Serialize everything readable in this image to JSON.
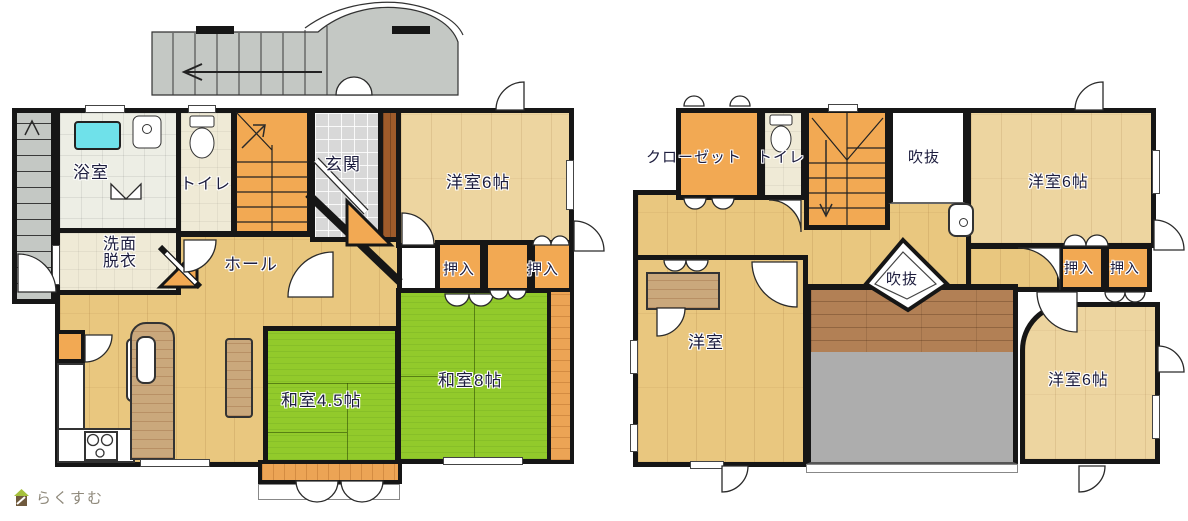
{
  "floor1": {
    "bathroom": "浴室",
    "washroom_line1": "洗面",
    "washroom_line2": "脱衣",
    "toilet": "トイレ",
    "entrance": "玄関",
    "western6": "洋室6帖",
    "hall": "ホール",
    "closet_a": "押入",
    "closet_b": "押入",
    "japanese45": "和室4.5帖",
    "japanese8": "和室8帖"
  },
  "floor2": {
    "closet": "クローゼット",
    "toilet": "トイレ",
    "void_top": "吹抜",
    "western6_ne": "洋室6帖",
    "closet_a": "押入",
    "closet_b": "押入",
    "western": "洋室",
    "void_center": "吹抜",
    "western6_se": "洋室6帖"
  },
  "watermark": {
    "icon": "house-icon",
    "text": "らくすむ"
  },
  "colors": {
    "wall": "#161616",
    "tatami_green": "#92ca2b",
    "wood_floor": "#e9c77f",
    "wood_light": "#edd5a0",
    "closet_orange": "#f2a953",
    "veranda_orange": "#eca455",
    "entrance_tile": "#d8d8d8",
    "bath_tile": "#edeee5",
    "cream_floor": "#efead6",
    "approach_gray": "#c4c8c4",
    "balcony_gray": "#adadad",
    "deck_brown": "#b28055",
    "bathtub_cyan": "#6fe1ea",
    "entrance_step_brown": "#9f5b2a",
    "label_text": "#1d1d3e",
    "watermark_text": "#8f897b"
  }
}
